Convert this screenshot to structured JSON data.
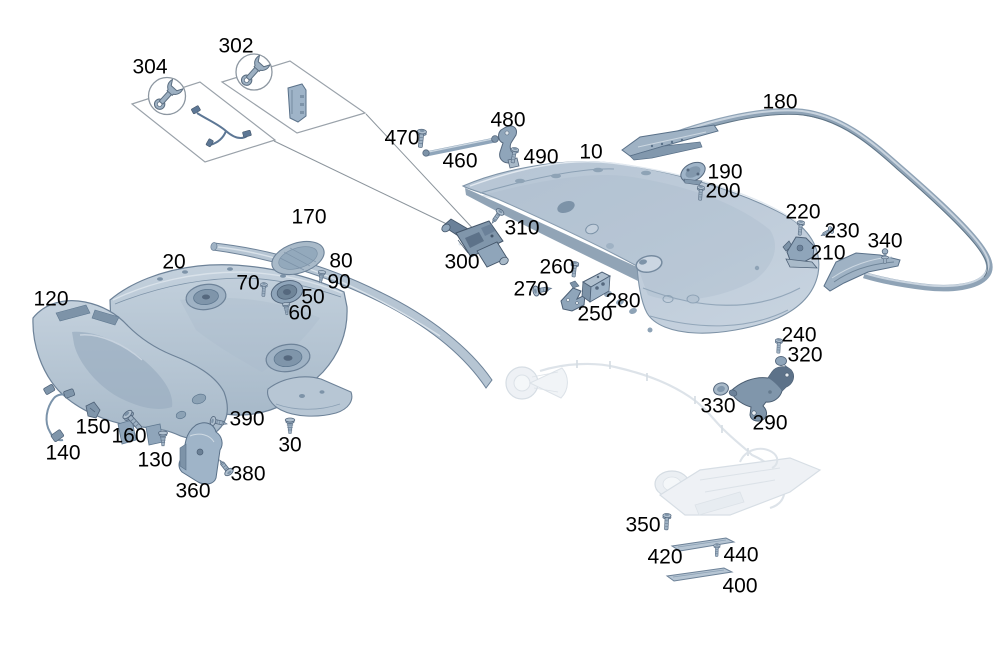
{
  "colors": {
    "background": "#ffffff",
    "part_fill_light": "#c2cfdc",
    "part_fill_mid": "#9fb2c4",
    "part_fill_dark": "#7d93a8",
    "mechanism_dark": "#5d7289",
    "outline": "#55687e",
    "ghost_fill": "#e3e9ef",
    "ghost_stroke": "#c5cfd9",
    "leader_line": "#8b949c",
    "label_color": "#000000"
  },
  "icons": {
    "kit_tool": "wrench-icon"
  },
  "kits": {
    "k304": {
      "label": "304",
      "icon": "wrench-icon"
    },
    "k302": {
      "label": "302",
      "icon": "wrench-icon"
    }
  },
  "callouts": {
    "c10": "10",
    "c20": "20",
    "c30": "30",
    "c50": "50",
    "c60": "60",
    "c70": "70",
    "c80": "80",
    "c90": "90",
    "c120": "120",
    "c130": "130",
    "c140": "140",
    "c150": "150",
    "c160": "160",
    "c170": "170",
    "c180": "180",
    "c190": "190",
    "c200": "200",
    "c210": "210",
    "c220": "220",
    "c230": "230",
    "c240": "240",
    "c250": "250",
    "c260": "260",
    "c270": "270",
    "c280": "280",
    "c290": "290",
    "c300": "300",
    "c302": "302",
    "c304": "304",
    "c310": "310",
    "c320": "320",
    "c330": "330",
    "c340": "340",
    "c350": "350",
    "c360": "360",
    "c380": "380",
    "c390": "390",
    "c400": "400",
    "c420": "420",
    "c440": "440",
    "c460": "460",
    "c470": "470",
    "c480": "480",
    "c490": "490"
  }
}
